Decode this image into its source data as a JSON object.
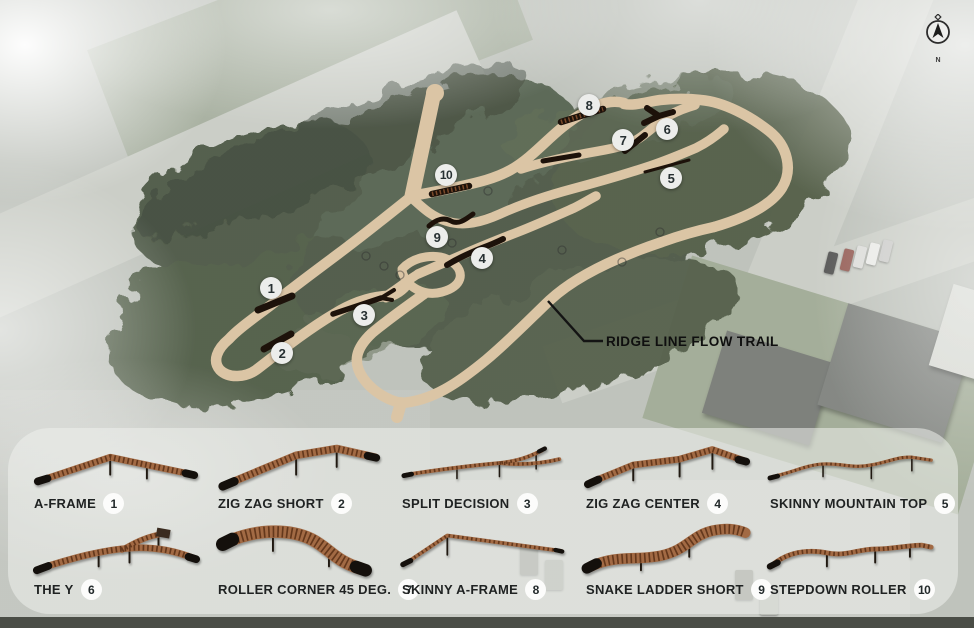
{
  "map": {
    "title_label": "RIDGE LINE FLOW TRAIL",
    "compass": {
      "label": "N"
    },
    "markers": [
      {
        "number": "1"
      },
      {
        "number": "2"
      },
      {
        "number": "3"
      },
      {
        "number": "4"
      },
      {
        "number": "5"
      },
      {
        "number": "6"
      },
      {
        "number": "7"
      },
      {
        "number": "8"
      },
      {
        "number": "9"
      },
      {
        "number": "10"
      }
    ],
    "colors": {
      "trail": "#dbc5a5",
      "feature": "#1d120a",
      "marker_bg": "#ecedeb",
      "marker_text": "#273032"
    }
  },
  "legend": {
    "items": [
      {
        "number": "1",
        "name": "A-FRAME"
      },
      {
        "number": "2",
        "name": "ZIG ZAG SHORT"
      },
      {
        "number": "3",
        "name": "SPLIT DECISION"
      },
      {
        "number": "4",
        "name": "ZIG ZAG CENTER"
      },
      {
        "number": "5",
        "name": "SKINNY MOUNTAIN TOP"
      },
      {
        "number": "6",
        "name": "THE Y"
      },
      {
        "number": "7",
        "name": "ROLLER CORNER 45 DEG."
      },
      {
        "number": "8",
        "name": "SKINNY A-FRAME"
      },
      {
        "number": "9",
        "name": "SNAKE LADDER SHORT"
      },
      {
        "number": "10",
        "name": "STEPDOWN ROLLER"
      }
    ]
  }
}
